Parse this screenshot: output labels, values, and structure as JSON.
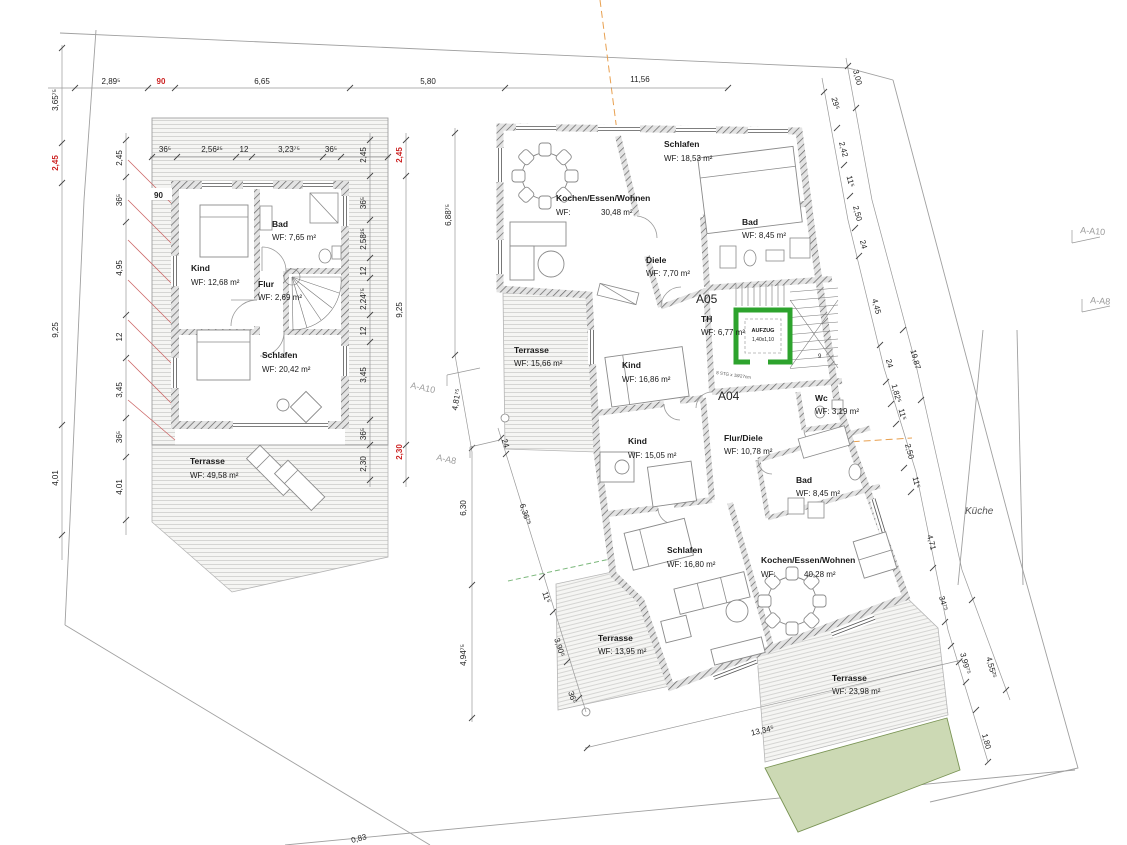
{
  "site": {
    "kueche": "Küche",
    "level_mark": "0,83"
  },
  "sections": {
    "a10": "A-A10",
    "a8": "A-A8"
  },
  "colors": {
    "dim_red": "#cc2222",
    "elevator_green": "#2da32d",
    "grass_green": "#ccd9b4",
    "orange_axis": "#e8a050",
    "green_axis": "#7cb87c",
    "section_gray": "#9a9a9a"
  },
  "dims": {
    "top": [
      "2,89⁵",
      "90",
      "6,65",
      "5,80",
      "11,56"
    ],
    "top_left_vertical": "3,65⁷⁵",
    "right_chain": [
      "29⁵",
      "2,42",
      "11⁵",
      "2,50",
      "24",
      "4,45",
      "24",
      "1,82⁵",
      "11⁵",
      "2,50",
      "11⁵",
      "4,71",
      "34⁷⁵",
      "3,99⁷⁵",
      "1,80"
    ],
    "right_overall": [
      "3,00",
      "19,87",
      "4,55²⁵"
    ],
    "bottom": "13,34⁵"
  },
  "left_plan": {
    "wall_mark": "90",
    "rooms": {
      "bad": {
        "name": "Bad",
        "area": "WF: 7,65 m²"
      },
      "kind": {
        "name": "Kind",
        "area": "WF: 12,68 m²"
      },
      "flur": {
        "name": "Flur",
        "area": "WF: 2,69 m²"
      },
      "schlafen": {
        "name": "Schlafen",
        "area": "WF: 20,42 m²"
      },
      "terrasse": {
        "name": "Terrasse",
        "area": "WF: 49,58 m²"
      }
    },
    "dims": {
      "top": [
        "36⁵",
        "2,56²⁵",
        "12",
        "3,23⁷⁵",
        "36⁵"
      ],
      "left_outer": [
        "2,45",
        "9,25",
        "4,01"
      ],
      "left_inner": [
        "2,45",
        "36⁵",
        "4,95",
        "12",
        "3,45",
        "36⁵",
        "4,01"
      ],
      "right_inner": [
        "2,45",
        "36⁵",
        "2,58²⁵",
        "12",
        "2,24⁷⁵",
        "12",
        "3,45",
        "36⁵",
        "2,30"
      ],
      "right_outer": [
        "2,45",
        "9,25",
        "2,30"
      ]
    }
  },
  "right_plan": {
    "units": {
      "a05": "A05",
      "a04": "A04"
    },
    "elevator": {
      "name": "AUFZUG",
      "size": "1,40x1,10"
    },
    "stairs": {
      "note": "8 STG x 18/27cm",
      "count": "9"
    },
    "rooms": {
      "kochen_a05": {
        "name": "Kochen/Essen/Wohnen",
        "wf": "WF:",
        "area": "30,48 m²"
      },
      "schlafen_a05": {
        "name": "Schlafen",
        "area": "WF: 18,53 m²"
      },
      "bad_a05": {
        "name": "Bad",
        "area": "WF: 8,45 m²"
      },
      "diele_a05": {
        "name": "Diele",
        "area": "WF: 7,70 m²"
      },
      "th": {
        "name": "TH",
        "area": "WF: 6,77 m²"
      },
      "kind1_a04": {
        "name": "Kind",
        "area": "WF: 16,86 m²"
      },
      "kind2_a04": {
        "name": "Kind",
        "area": "WF: 15,05 m²"
      },
      "flur_diele_a04": {
        "name": "Flur/Diele",
        "area": "WF: 10,78 m²"
      },
      "wc_a04": {
        "name": "Wc",
        "area": "WF: 3,19 m²"
      },
      "bad_a04": {
        "name": "Bad",
        "area": "WF: 8,45 m²"
      },
      "schlafen_a04": {
        "name": "Schlafen",
        "area": "WF: 16,80 m²"
      },
      "kochen_a04": {
        "name": "Kochen/Essen/Wohnen",
        "wf": "WF:",
        "area": "40,28 m²"
      },
      "terrasse_west": {
        "name": "Terrasse",
        "area": "WF: 15,66 m²"
      },
      "terrasse_sued": {
        "name": "Terrasse",
        "area": "WF: 13,95 m²"
      },
      "terrasse_ost": {
        "name": "Terrasse",
        "area": "WF: 23,98 m²"
      }
    },
    "dims": {
      "left_vertical": [
        "6,88⁷⁵",
        "4,81⁷⁵",
        "6,30",
        "4,94⁷⁵"
      ],
      "slant_chain": [
        "24",
        "6,36⁷⁵",
        "11⁵",
        "3,90⁵",
        "36⁵"
      ]
    }
  }
}
